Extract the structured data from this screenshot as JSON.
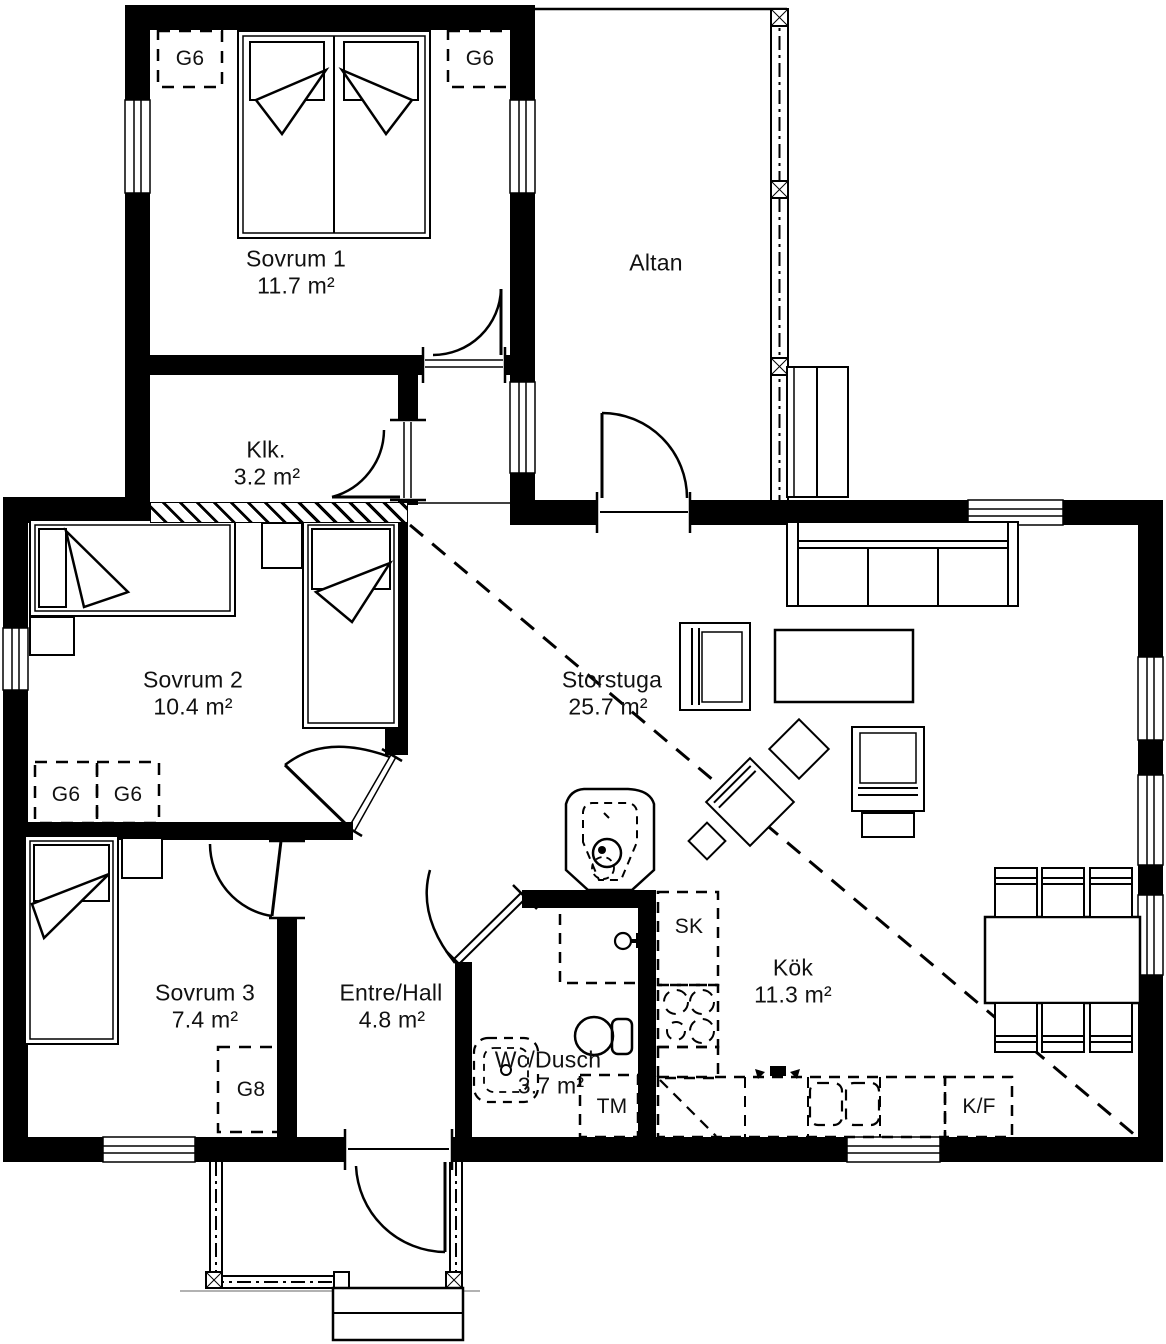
{
  "meta": {
    "type": "architectural floor plan",
    "language": "Swedish"
  },
  "rooms": {
    "sovrum1": {
      "name": "Sovrum 1",
      "area": "11.7 m²"
    },
    "klk": {
      "name": "Klk.",
      "area": "3.2 m²"
    },
    "altan": {
      "name": "Altan",
      "area": ""
    },
    "sovrum2": {
      "name": "Sovrum 2",
      "area": "10.4 m²"
    },
    "storstuga": {
      "name": "Storstuga",
      "area": "25.7 m²"
    },
    "sovrum3": {
      "name": "Sovrum 3",
      "area": "7.4 m²"
    },
    "entre": {
      "name": "Entre/Hall",
      "area": "4.8 m²"
    },
    "wc": {
      "name": "Wc/Dusch",
      "area": "3.7 m²"
    },
    "kok": {
      "name": "Kök",
      "area": "11.3 m²"
    }
  },
  "fixtures": {
    "wardrobe_g6": "G6",
    "wardrobe_g8": "G8",
    "tall_cabinet_sk": "SK",
    "washing_machine_tm": "TM",
    "fridge_freezer_kf": "K/F"
  },
  "colors": {
    "wall": "#000000",
    "background": "#ffffff",
    "text": "#111111"
  }
}
